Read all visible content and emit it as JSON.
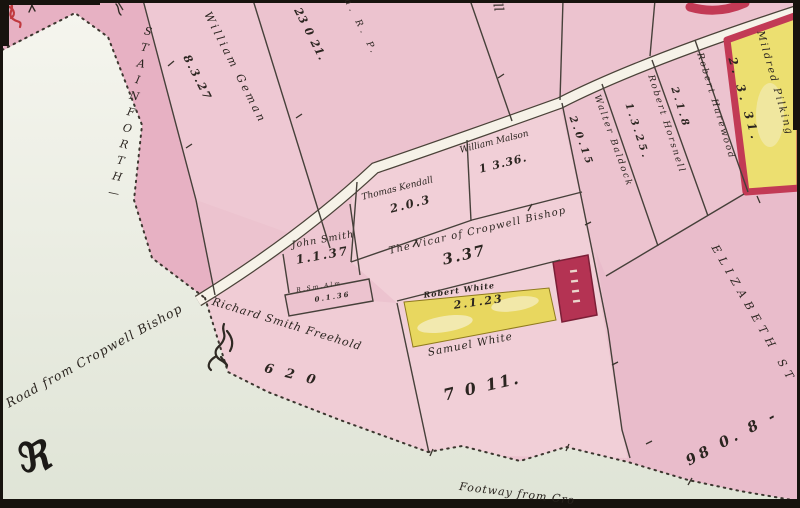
{
  "map": {
    "road_labels": {
      "stainforth": "STAINFORTH—",
      "road_from_cropwell": "Road from Cropwell Bishop",
      "footway": "Footway from Cro",
      "elizabeth_street": "ELIZABETH ST"
    },
    "plots": {
      "william_geman": {
        "name": "William Geman",
        "area": "8.3.27"
      },
      "arp_header": {
        "name": "a. R. P.",
        "area": "23 0 21."
      },
      "hall_fragment": {
        "name": "ll"
      },
      "thomas_kendall": {
        "name": "Thomas Kendall",
        "area": "2.0.3"
      },
      "william_malson": {
        "name": "William Malson",
        "area": "1 3.36."
      },
      "vicar": {
        "name": "The Vicar of Cropwell Bishop",
        "area": "3.37"
      },
      "john_smith": {
        "name": "John Smith",
        "area": "1.1.37"
      },
      "smith_alms": {
        "name": "R.Sm.Alm",
        "area": "0.1.36"
      },
      "robert_white": {
        "name": "Robert White",
        "area": "2.1.23"
      },
      "samuel_white": {
        "name": "Samuel White",
        "area": "7 0 11."
      },
      "richard_smith": {
        "name": "Richard Smith Freehold",
        "area": "6 2 0"
      },
      "robert_harewood": {
        "name": "Robert Harewood",
        "area": "2.1.8"
      },
      "robert_horsnell": {
        "name": "Robert Horsnell",
        "area": "1.3.25."
      },
      "walter_baldock": {
        "name": "Walter Baldock",
        "area": "2.0.15"
      },
      "mildred_pilking": {
        "name": "Mildred Pilking",
        "area": "2. 3. 31."
      },
      "elizabeth_field": {
        "area": "98 0. 8 -"
      }
    },
    "marks": {
      "initial_r": "ℜ"
    },
    "colors": {
      "plot_pink": "#ecc3cf",
      "deep_rose": "#e29fb7",
      "road_cream": "#f6f2e8",
      "pale_green": "#e2e6d9",
      "plot_yellow": "#e8d75f",
      "building_red": "#c23a55",
      "ink": "#2b2520"
    }
  }
}
